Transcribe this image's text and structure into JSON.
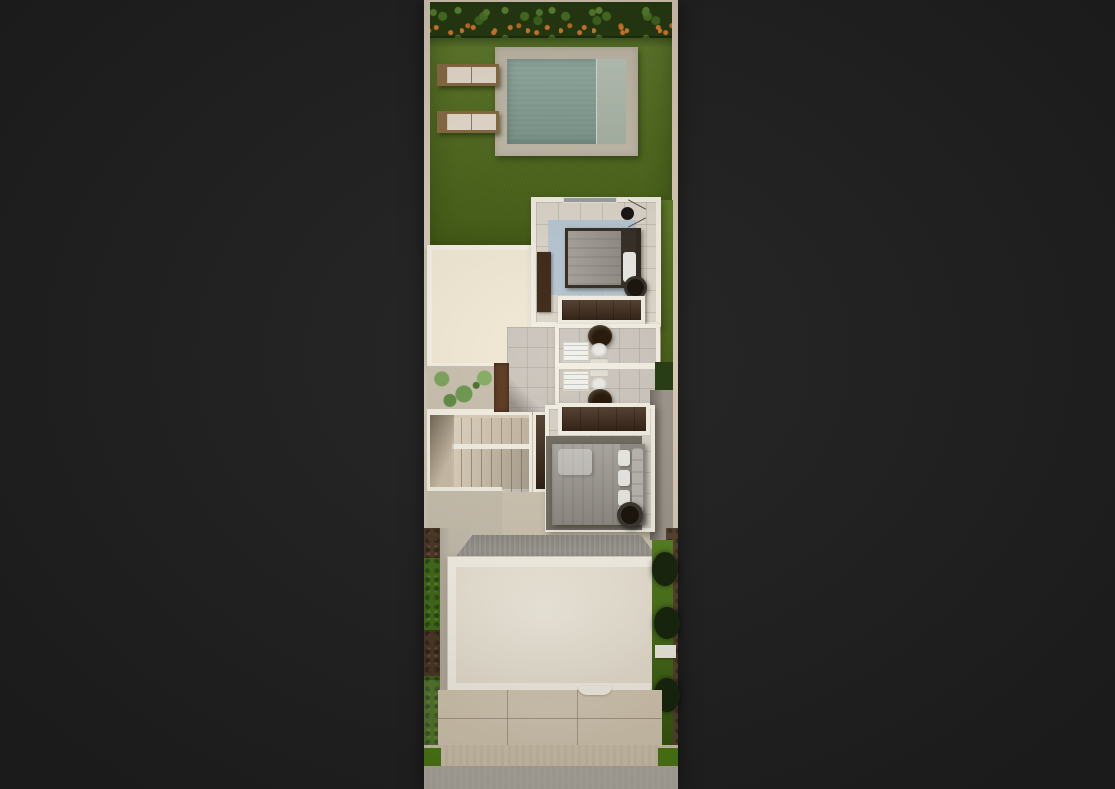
{
  "meta": {
    "description": "Top-down 3D architectural render of a narrow residential lot floor plan, centered on a dark backdrop",
    "view": "plan view render",
    "text_content": "none — image contains no readable text"
  },
  "palette": {
    "backdrop": "#212121",
    "boundary_wall": "#d8ccb6",
    "wall_white": "#f4efe3",
    "grass": "#557517",
    "grass_front": "#4c7a12",
    "hedge_green": "#23390f",
    "hedge_flower": "#d9782a",
    "pool_deck": "#c7beac",
    "pool_water": "#8aa89b",
    "pool_ledge": "#b5c2b3",
    "lounger_wood": "#8a6c42",
    "lounger_cushion": "#ece2d4",
    "roof_blank": "#f3e9d6",
    "floor_tile": "#ddd6ca",
    "floor_gray": "#ccc6bd",
    "rug_blue": "#b5c7d3",
    "rug_dark": "#6b665c",
    "bed_duvet": "#9d9890",
    "bed_linen_white": "#eceae5",
    "wood_dark": "#3e2817",
    "stool_dark": "#171108",
    "stair_tread": "#dbcdb6",
    "plant_green": "#7ba35b",
    "planter_box": "#5c3a20",
    "concrete": "#c7bead",
    "concrete_shadow": "#9c958a",
    "pergola_gray": "#9f9b93",
    "roof_white": "#fbf6ea",
    "roof_cream": "#f6eedd",
    "driveway": "#d8cbb4",
    "sidewalk": "#d5c8b0",
    "road": "#b2ada3",
    "soil_brown": "#55402c",
    "hedge_brown": "#4a3523",
    "bush_dark": "#15230a",
    "toilet_white": "#f0eee8",
    "vanity_white": "#f2f1ec",
    "window_gray": "#9aa0a0",
    "vessel_sink": "#241505",
    "terrace": "#c9c0ae",
    "base_lower": "#cfc5b2",
    "bedroom2_floor": "#d8d2c8",
    "hedge_green_bright": "#3f6b14"
  },
  "objects": [
    {
      "name": "flowering-hedge",
      "desc": "hedge with orange flowers along rear boundary"
    },
    {
      "name": "backyard-lawn",
      "desc": "rear garden lawn"
    },
    {
      "name": "swimming-pool",
      "desc": "plunge pool with tanning ledge on right side"
    },
    {
      "name": "sun-loungers",
      "desc": "two wooden sun loungers with cream cushions"
    },
    {
      "name": "upper-bedroom",
      "desc": "bedroom with double bed, blue rug, TV console, tripod lamp, side table, wardrobe"
    },
    {
      "name": "bathrooms",
      "desc": "two back-to-back bathrooms with toilets, washbasin units and round vessel sinks"
    },
    {
      "name": "hallway",
      "desc": "tiled corridor beside bathrooms"
    },
    {
      "name": "roof-void",
      "desc": "blank cream roof over lower-level room"
    },
    {
      "name": "patio-planter",
      "desc": "planter bed with green plants and wooden box"
    },
    {
      "name": "staircase",
      "desc": "U-shaped staircase with winder steps"
    },
    {
      "name": "lower-bedroom",
      "desc": "bedroom with double bed, dark rug, wardrobe and round stool"
    },
    {
      "name": "carport-pergola",
      "desc": "gray shade band over entry"
    },
    {
      "name": "garage-roof",
      "desc": "large cream roof slab over garage"
    },
    {
      "name": "driveway",
      "desc": "paved driveway with expansion seams"
    },
    {
      "name": "side-hedges",
      "desc": "hedge and shrub strips along side boundaries"
    },
    {
      "name": "sidewalk-and-road",
      "desc": "front sidewalk with lawn corners and street"
    }
  ]
}
